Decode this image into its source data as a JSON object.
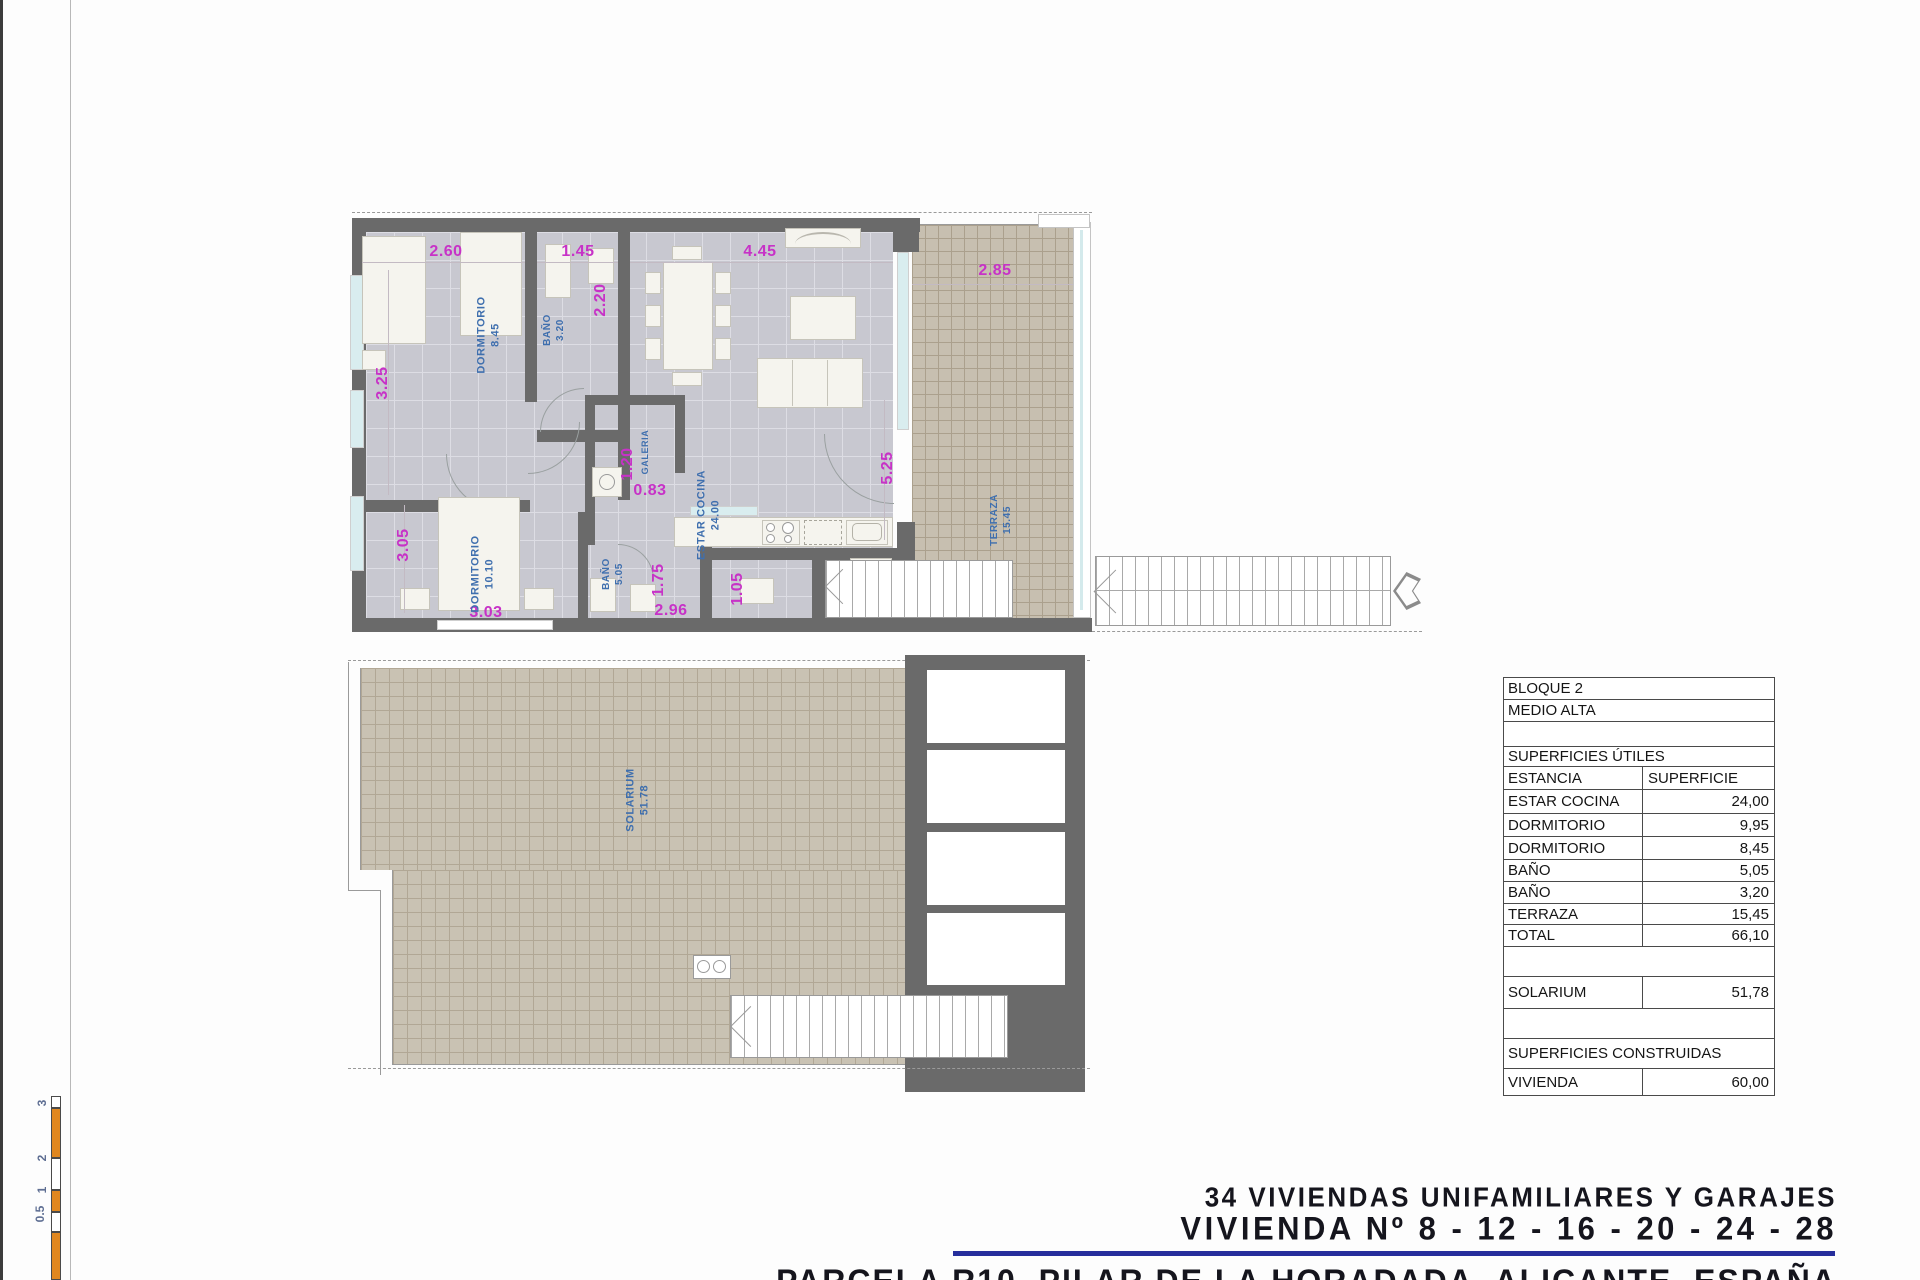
{
  "upper_plan": {
    "dims": {
      "d260": "2.60",
      "d145": "1.45",
      "d445": "4.45",
      "d285": "2.85",
      "d325": "3.25",
      "d220": "2.20",
      "d525": "5.25",
      "d305": "3.05",
      "d120": "1.20",
      "d083": "0.83",
      "d303": "3.03",
      "d175": "1.75",
      "d296": "2.96",
      "d105": "1.05"
    },
    "rooms": {
      "dorm1": {
        "name": "DORMITORIO",
        "area": "8.45"
      },
      "bano1": {
        "name": "BAÑO",
        "area": "3.20"
      },
      "estar": {
        "name": "ESTAR COCINA",
        "area": "24.00"
      },
      "galeria": {
        "name": "GALERIA",
        "area": ""
      },
      "dorm2": {
        "name": "DORMITORIO",
        "area": "10.10"
      },
      "bano2": {
        "name": "BAÑO",
        "area": "5.05"
      },
      "terraza": {
        "name": "TERRAZA",
        "area": "15.45"
      }
    }
  },
  "lower_plan": {
    "solarium": {
      "name": "SOLARIUM",
      "area": "51.78"
    }
  },
  "table": {
    "row_bloque": "BLOQUE 2",
    "row_medio": "MEDIO ALTA",
    "row_sup_utiles": "SUPERFICIES ÚTILES",
    "header": {
      "estancia": "ESTANCIA",
      "superficie": "SUPERFICIE"
    },
    "rows": [
      [
        "ESTAR COCINA",
        "24,00"
      ],
      [
        "DORMITORIO",
        "9,95"
      ],
      [
        "DORMITORIO",
        "8,45"
      ],
      [
        "BAÑO",
        "5,05"
      ],
      [
        "BAÑO",
        "3,20"
      ],
      [
        "TERRAZA",
        "15,45"
      ],
      [
        "TOTAL",
        "66,10"
      ]
    ],
    "solarium": [
      "SOLARIUM",
      "51,78"
    ],
    "sup_construidas": "SUPERFICIES CONSTRUIDAS",
    "vivienda": [
      "VIVIENDA",
      "60,00"
    ]
  },
  "titleblock": {
    "line1": "34 VIVIENDAS UNIFAMILIARES Y GARAJES",
    "line2": "VIVIENDA Nº 8 - 12 - 16 - 20 - 24 - 28",
    "line3": "PARCELA R10, PILAR DE LA HORADADA, ALICANTE, ESPAÑA"
  },
  "scalebar": {
    "labels": [
      "3",
      "2",
      "1",
      "0.5"
    ]
  },
  "colors": {
    "dimension": "#c732c7",
    "room_label": "#3f6fae",
    "wall": "#6a6a6a",
    "terrace_tile": "#c7bfb0",
    "accent_rule": "#262e9c",
    "scale_orange": "#e0871f"
  }
}
